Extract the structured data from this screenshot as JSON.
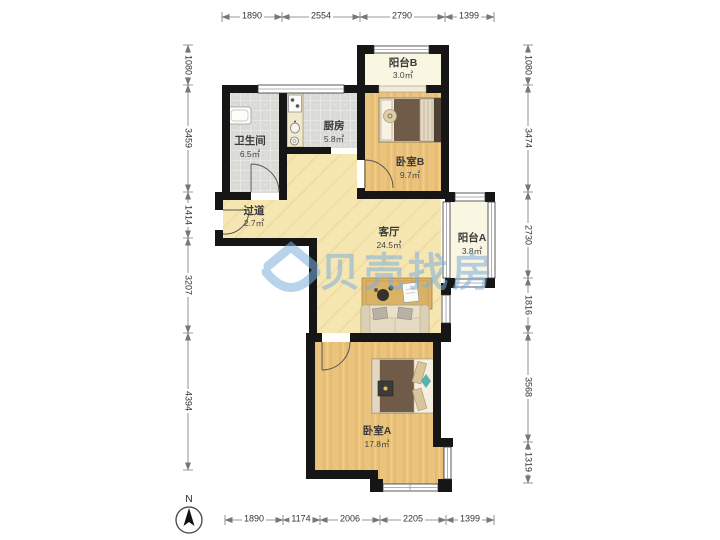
{
  "watermark": {
    "text": "贝壳找房",
    "color": "#7fb0dd"
  },
  "compass": {
    "north_label": "N"
  },
  "rooms": {
    "balcony_b": {
      "name": "阳台B",
      "area": "3.0㎡"
    },
    "bathroom": {
      "name": "卫生间",
      "area": "6.5㎡"
    },
    "kitchen": {
      "name": "厨房",
      "area": "5.8㎡"
    },
    "bedroom_b": {
      "name": "卧室B",
      "area": "9.7㎡"
    },
    "hallway": {
      "name": "过道",
      "area": "2.7㎡"
    },
    "living_room": {
      "name": "客厅",
      "area": "24.5㎡"
    },
    "balcony_a": {
      "name": "阳台A",
      "area": "3.8㎡"
    },
    "bedroom_a": {
      "name": "卧室A",
      "area": "17.8㎡"
    }
  },
  "dimensions": {
    "top": [
      "1890",
      "2554",
      "2790",
      "1399"
    ],
    "bottom": [
      "1890",
      "1174",
      "2006",
      "2205",
      "1399"
    ],
    "left": [
      "1080",
      "3459",
      "1414",
      "3207",
      "4394"
    ],
    "right": [
      "1080",
      "3474",
      "2730",
      "1816",
      "3568",
      "1319"
    ]
  }
}
